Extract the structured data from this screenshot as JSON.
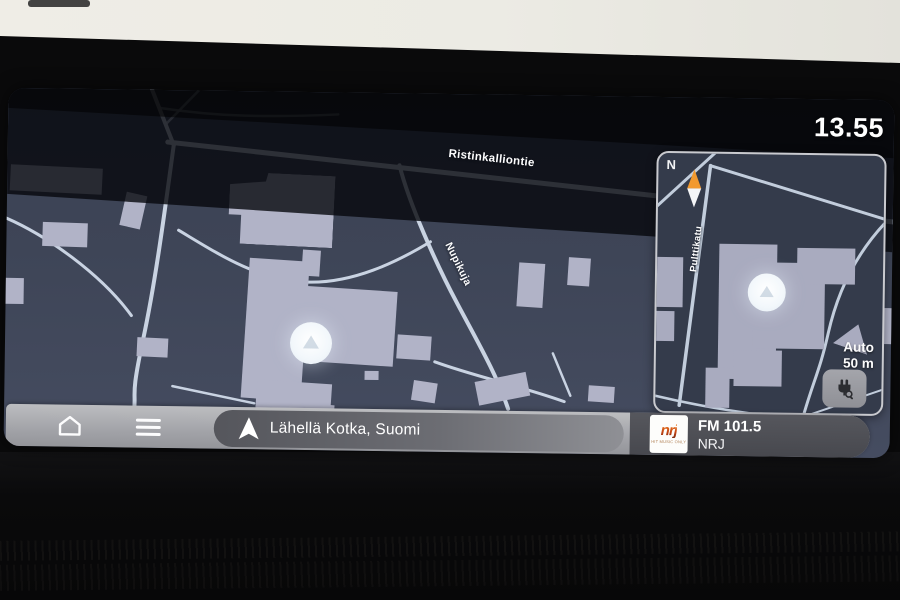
{
  "status": {
    "clock": "13.55"
  },
  "map": {
    "primary_road_label": "Ristinkalliontie",
    "secondary_road_label": "Nupikuja"
  },
  "minimap": {
    "compass": "N",
    "road_label": "Pulttikatu",
    "zoom_mode": "Auto",
    "zoom_scale": "50 m"
  },
  "bottom_bar": {
    "location_pill": "Lähellä Kotka, Suomi",
    "radio": {
      "logo_text": "nrj",
      "logo_tagline": "HIT MUSIC ONLY",
      "frequency": "FM 101.5",
      "station": "NRJ"
    }
  },
  "colors": {
    "map_background": "#3e4557",
    "road": "#c9d3e2",
    "building": "#b1b3c7",
    "compass_north": "#f2992e",
    "bar_gray": "#a2a3a8",
    "pill_gray": "#6c6d73",
    "clock_text": "#ffffff"
  }
}
